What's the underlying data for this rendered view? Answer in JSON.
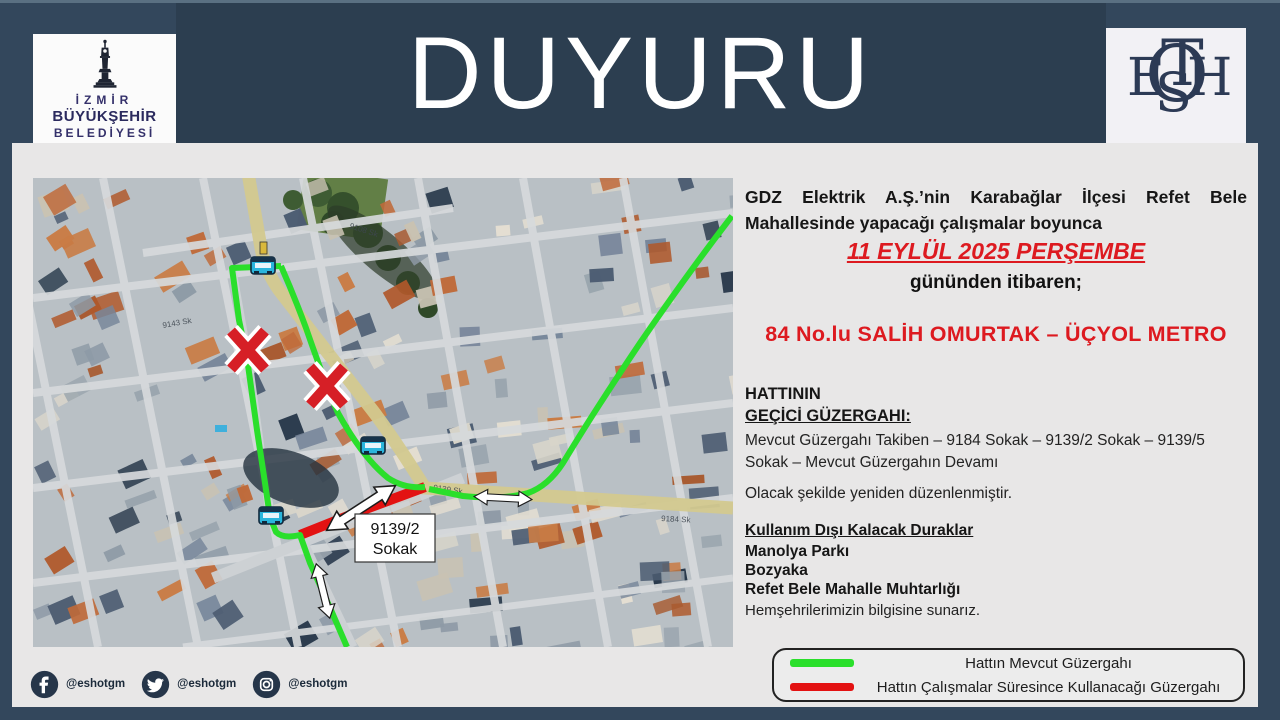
{
  "frame": {
    "title": "DUYURU"
  },
  "logos": {
    "izmir": {
      "line1": "İZMİR",
      "line2": "BÜYÜKŞEHİR",
      "line3": "BELEDİYESİ"
    },
    "eshot": {
      "letters": [
        "O",
        "E",
        "T",
        "S",
        "H"
      ]
    }
  },
  "announcement": {
    "intro": "GDZ Elektrik A.Ş.’nin Karabağlar İlçesi Refet Bele Mahallesinde yapacağı çalışmalar boyunca",
    "date": "11 EYLÜL 2025 PERŞEMBE",
    "date_suffix": "gününden itibaren;",
    "route_name": "84 No.lu SALİH OMURTAK – ÜÇYOL METRO",
    "route_label1": "HATTININ",
    "route_label2": "GEÇİCİ GÜZERGAHI:",
    "temp_route": "Mevcut Güzergahı Takiben – 9184 Sokak – 9139/2 Sokak – 9139/5 Sokak  – Mevcut Güzergahın Devamı",
    "arrangement_note": "Olacak şekilde yeniden düzenlenmiştir.",
    "closed_stops_title": "Kullanım Dışı Kalacak Duraklar",
    "closed_stops": [
      "Manolya Parkı",
      "Bozyaka",
      "Refet Bele Mahalle Muhtarlığı"
    ],
    "closing_note": "Hemşehrilerimizin bilgisine sunarız."
  },
  "map": {
    "label_box": {
      "line1": "9139/2",
      "line2": "Sokak"
    },
    "street_labels": [
      {
        "text": "9143 Sk"
      },
      {
        "text": "9108 Sk"
      },
      {
        "text": "9139 Sk"
      },
      {
        "text": "9184 Sk"
      }
    ],
    "colors": {
      "current_route": "#2adf2b",
      "works_route": "#e31212",
      "closed_x": "#d61f26"
    },
    "palette": [
      "#bf6a3a",
      "#c97c45",
      "#a85a30",
      "#b0582a",
      "#e4ded2",
      "#d9d5ca",
      "#8e9aa6",
      "#77869a",
      "#4d5d72",
      "#c9c2b2",
      "#9aa5ae",
      "#2a3a4c"
    ]
  },
  "legend": {
    "items": [
      {
        "color": "#2adf2b",
        "label": "Hattın Mevcut Güzergahı"
      },
      {
        "color": "#e31212",
        "label": "Hattın Çalışmalar Süresince Kullanacağı Güzergahı"
      }
    ]
  },
  "social": {
    "accounts": [
      {
        "platform": "facebook",
        "handle": "@eshotgm"
      },
      {
        "platform": "twitter",
        "handle": "@eshotgm"
      },
      {
        "platform": "instagram",
        "handle": "@eshotgm"
      }
    ]
  }
}
